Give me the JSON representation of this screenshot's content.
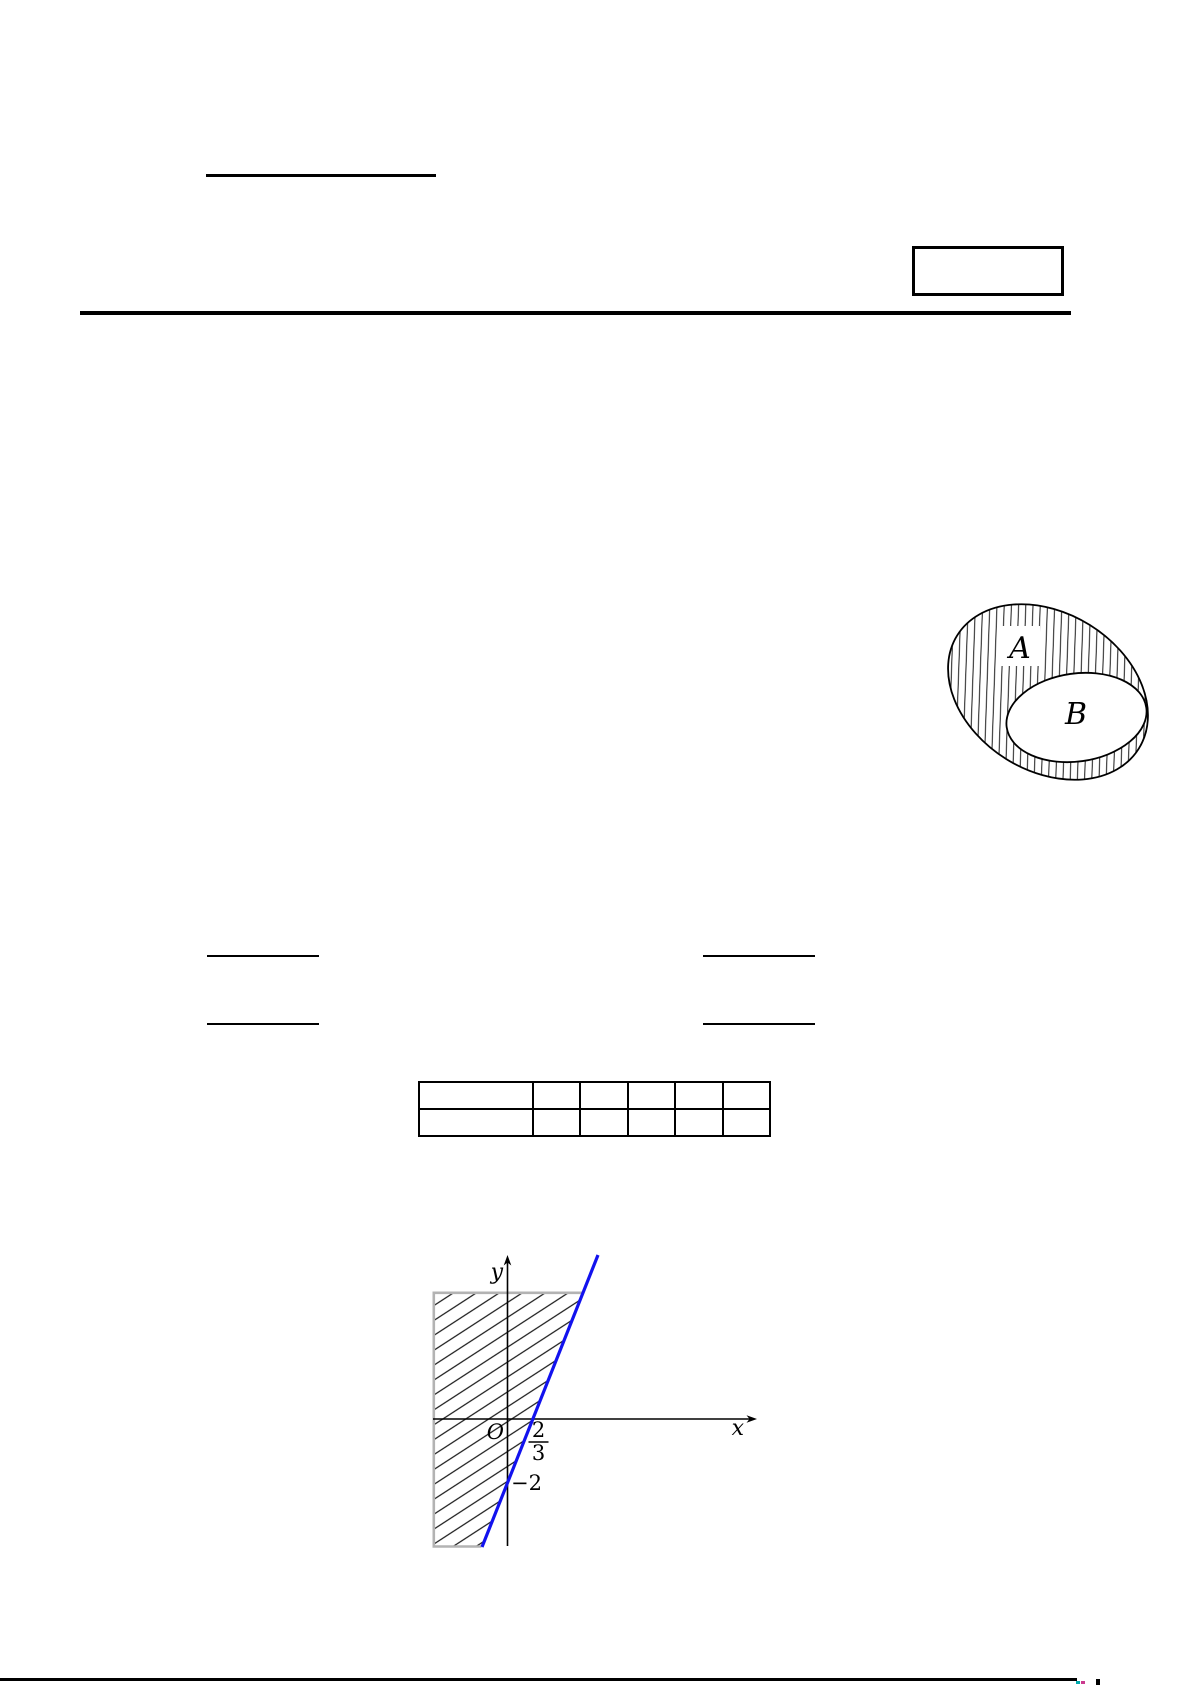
{
  "page": {
    "background": "#ffffff"
  },
  "colors": {
    "ink": "#000000",
    "line_blue": "#1212ee",
    "hatch_border_gray": "#b3b3b3",
    "footer_mark_cyan": "#00a9ad",
    "footer_mark_magenta": "#cb3a8e"
  },
  "venn": {
    "label_a": "A",
    "label_b": "B",
    "hatched_region": "inside A, outside B"
  },
  "graph": {
    "y_axis_label": "y",
    "x_axis_label": "x",
    "origin_label": "O",
    "x_intercept_numerator": "2",
    "x_intercept_denominator": "3",
    "y_intercept_label": "−2"
  },
  "chart_data": {
    "type": "line",
    "title": "",
    "xlabel": "x",
    "ylabel": "y",
    "lines": [
      {
        "slope": 3,
        "y_intercept": -2,
        "x_intercept": "2/3",
        "color": "#1212ee"
      }
    ],
    "annotations": [
      "O",
      "2/3",
      "−2"
    ],
    "shaded_region": "hatched half-plane to the left of the blue line y = 3x − 2",
    "legend": "none",
    "grid": false
  }
}
